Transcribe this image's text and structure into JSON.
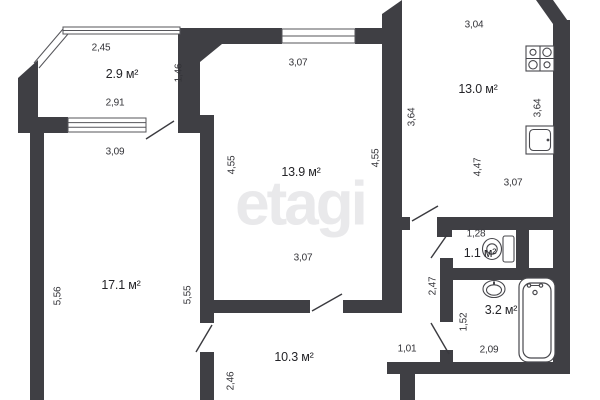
{
  "watermark": "etagi",
  "colors": {
    "wall": "#3f3f44",
    "thin_line": "#55555a",
    "door_line": "#3a3a3f",
    "label_text": "#333338",
    "watermark_gray": "#e9e9eb"
  },
  "rooms": {
    "balcony": {
      "area": "2.9 м²",
      "dim_top": "2,45",
      "dim_right": "1,46",
      "dim_bottom": "2,91"
    },
    "living": {
      "area": "17.1 м²",
      "dim_left": "5,56",
      "dim_right": "5,55",
      "dim_window": "3,09",
      "dim_door": "2,46"
    },
    "bedroom": {
      "area": "13.9 м²",
      "dim_top": "3,07",
      "dim_left": "4,55",
      "dim_right": "4,55",
      "dim_bottom": "3,07"
    },
    "kitchen": {
      "area": "13.0 м²",
      "dim_top": "3,04",
      "dim_left": "3,64",
      "dim_right": "3,64",
      "dim_inner": "4,47",
      "dim_bottom": "3,07"
    },
    "wc": {
      "area": "1.1 м²",
      "dim_top": "1,28"
    },
    "bathroom": {
      "area": "3.2 м²",
      "dim_left": "1,52",
      "dim_bottom": "2,09"
    },
    "hallway": {
      "area": "10.3 м²",
      "dim_right": "2,47",
      "dim_bottom": "1,01"
    }
  },
  "fixtures": [
    "stove-icon",
    "kitchen-sink-icon",
    "toilet-icon",
    "washbasin-icon",
    "bathtub-icon"
  ]
}
